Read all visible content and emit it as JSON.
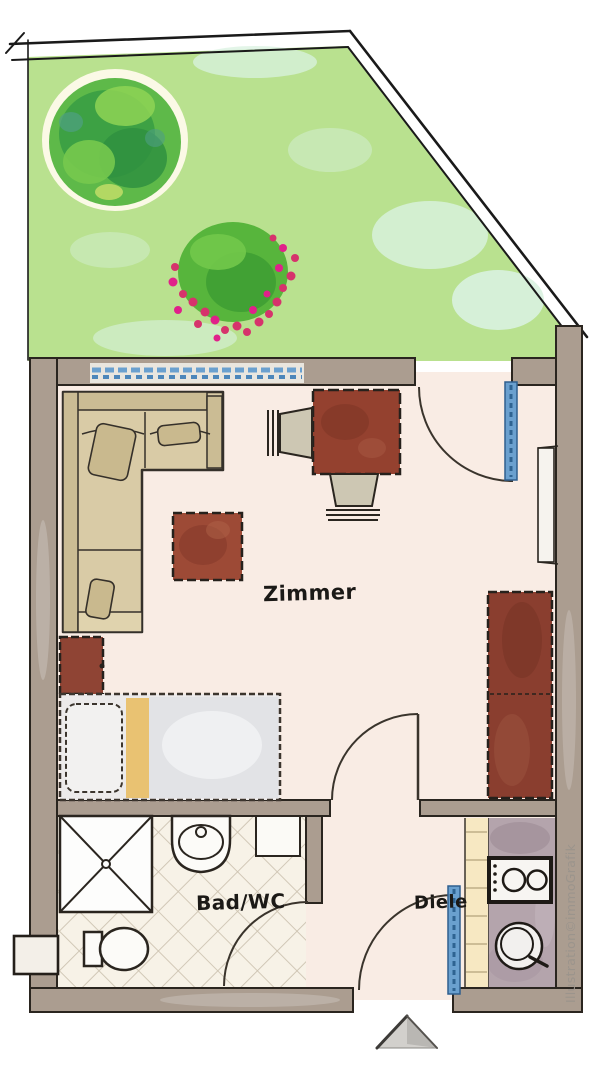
{
  "title": "Apartment floor plan with garden",
  "rooms": {
    "zimmer": {
      "label": "Zimmer",
      "furniture": [
        "corner-sofa",
        "coffee-table",
        "dining-table",
        "chairs",
        "side-table",
        "bed",
        "wardrobe",
        "terrace-door",
        "room-door",
        "wall-window"
      ]
    },
    "bad": {
      "label": "Bad/WC",
      "fixtures": [
        "shower",
        "washbasin",
        "toilet",
        "cabinet",
        "bath-door",
        "tiled-floor"
      ]
    },
    "diele": {
      "label": "Diele",
      "fixtures": [
        "entrance-door",
        "shelf"
      ]
    },
    "kitchenette": {
      "fixtures": [
        "cooktop",
        "sink",
        "counter"
      ]
    }
  },
  "garden": {
    "features": [
      "lawn",
      "tree",
      "flower-bush",
      "boundary-fence"
    ]
  },
  "watermark": "Illustration©immoGrafik",
  "entrance_marker": "arrow-up",
  "colors": {
    "lawn": "#b9e18f",
    "lawn_patch": "#d9f2e0",
    "tree_green": "#3da144",
    "flower_pink": "#d6336c",
    "wall": "#ab9d90",
    "floor": "#f9ece4",
    "bath_floor": "#f7f2e7",
    "window_blue": "#5b9bd5",
    "sofa_beige": "#d9cba6",
    "wood_brown": "#94412f",
    "bed_stripe_yellow": "#e9c272",
    "kitchen_counter": "#b4a4ac",
    "shelf_yellow": "#f7e8c2",
    "outline": "#2a251f",
    "watermark_gray": "#9b948c"
  }
}
